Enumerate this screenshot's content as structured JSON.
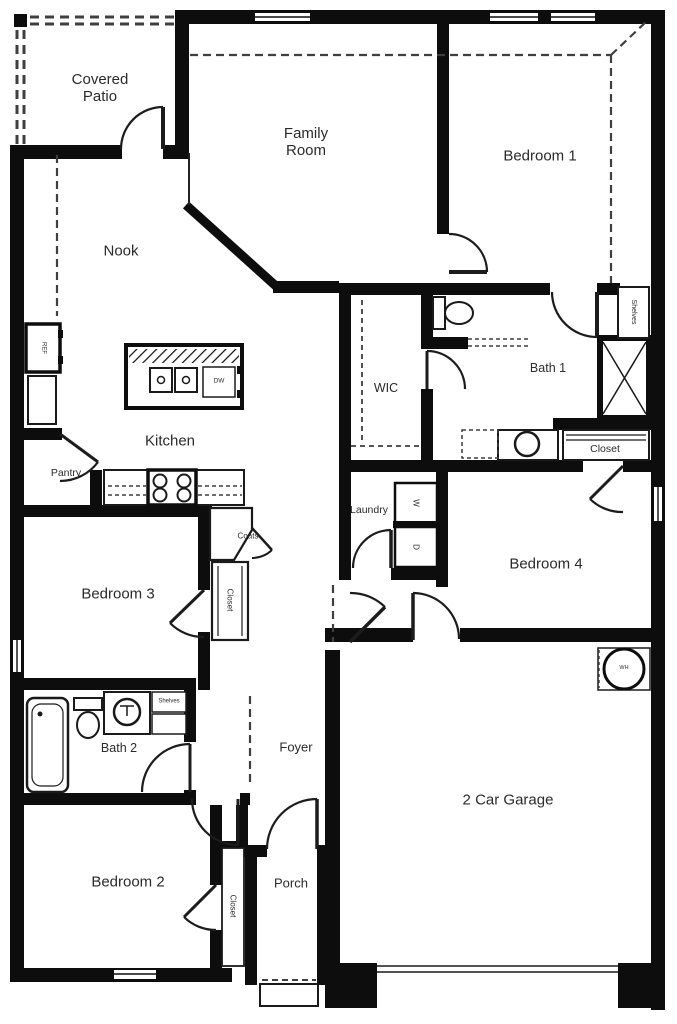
{
  "document_type": "residential floor plan",
  "colors": {
    "wall": "#0d0d0d",
    "thin_line": "#1a1a1a",
    "dashed_line": "#3f3f3f",
    "text": "#2b2b2b",
    "background": "#ffffff"
  },
  "labels": {
    "covered_patio": "Covered Patio",
    "family_room": "Family Room",
    "bedroom_1": "Bedroom 1",
    "nook": "Nook",
    "wic": "WIC",
    "bath_1": "Bath 1",
    "shelves_bed1": "Shelves",
    "closet_bath1": "Closet",
    "kitchen": "Kitchen",
    "pantry": "Pantry",
    "refrigerator": "REF",
    "dishwasher": "DW",
    "laundry": "Laundry",
    "washer": "W",
    "dryer": "D",
    "coats": "Coats",
    "closet_bed3": "Closet",
    "bedroom_4": "Bedroom 4",
    "bedroom_3": "Bedroom 3",
    "bath_2": "Bath 2",
    "shelves_bath2": "Shelves",
    "foyer": "Foyer",
    "bedroom_2": "Bedroom 2",
    "closet_bed2": "Closet",
    "porch": "Porch",
    "garage": "2 Car Garage",
    "water_heater": "WH"
  },
  "icons": [
    "toilet-icon",
    "bathtub-icon",
    "shower-icon",
    "sink-icon",
    "stove-icon",
    "kitchen-island",
    "dishwasher-icon",
    "refrigerator-icon",
    "washer-icon",
    "dryer-icon",
    "water-heater-icon",
    "door-swing-icon",
    "window-icon",
    "garage-door-icon",
    "porch-steps-icon"
  ]
}
